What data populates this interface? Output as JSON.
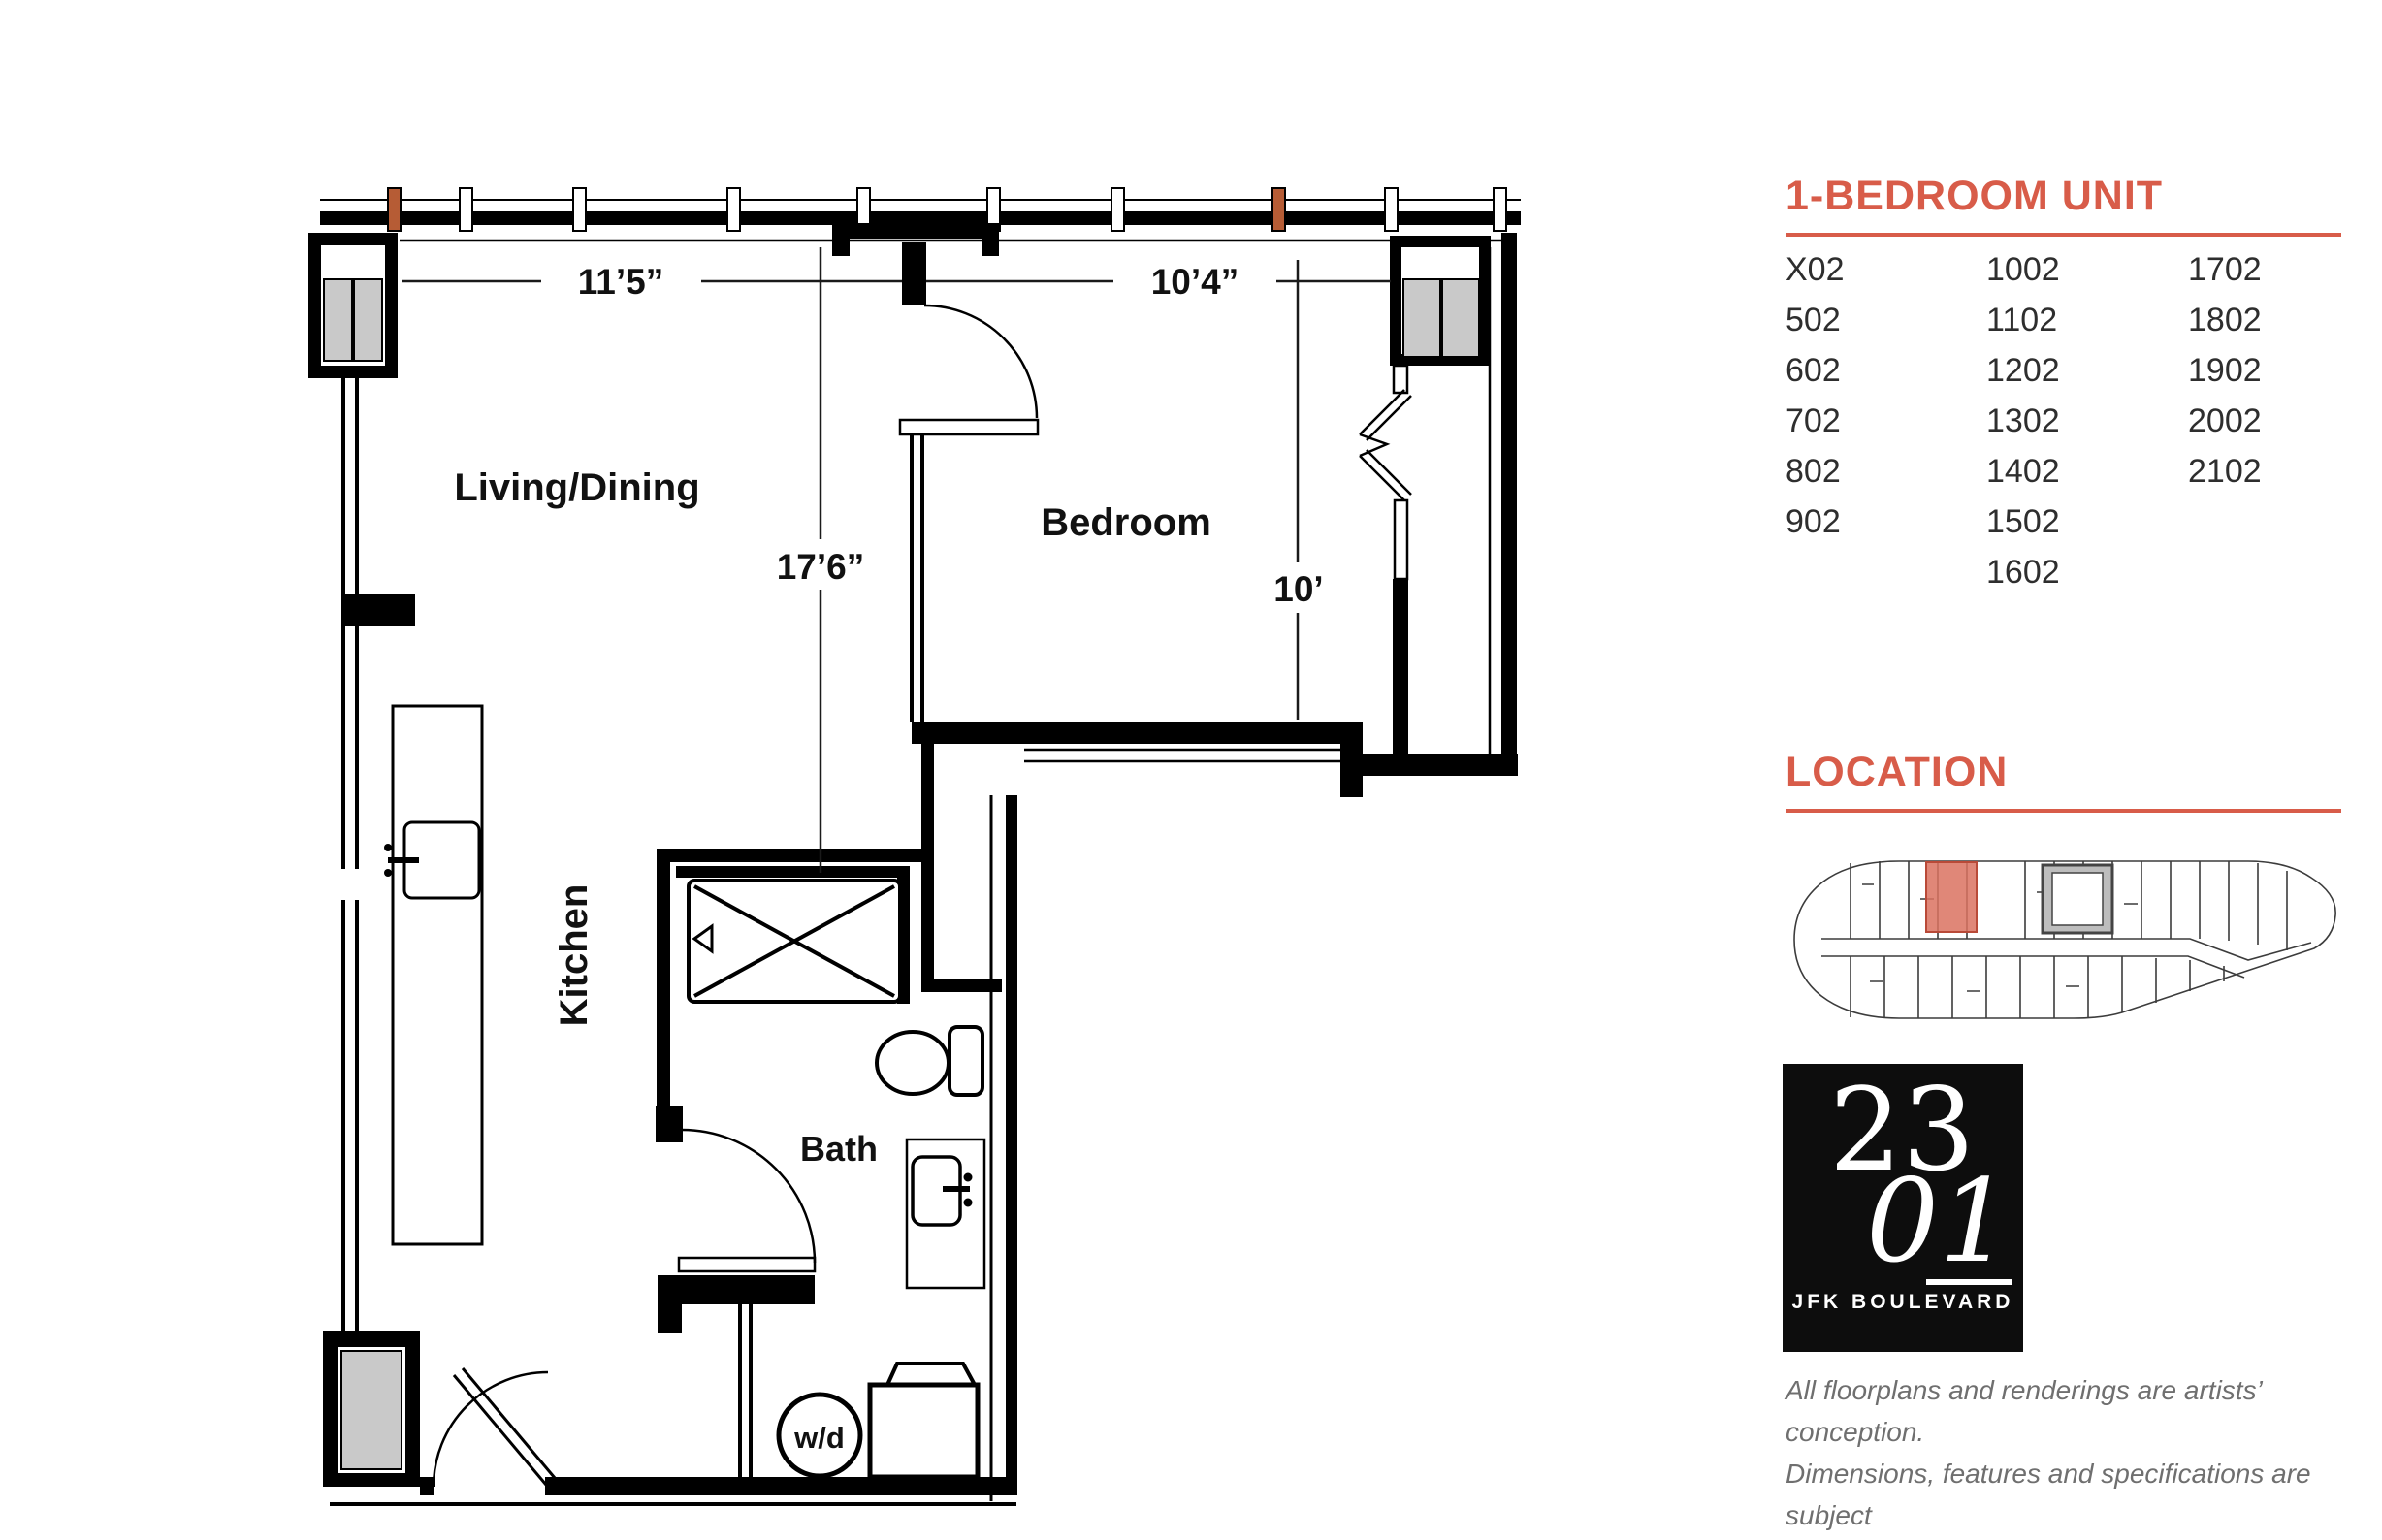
{
  "floor_plan": {
    "rooms": {
      "living": "Living/Dining",
      "bedroom": "Bedroom",
      "kitchen": "Kitchen",
      "bath": "Bath",
      "washer_dryer": "w/d"
    },
    "dimensions": {
      "living_width": "11’5”",
      "bedroom_width": "10’4”",
      "living_length": "17’6”",
      "bedroom_depth": "10’"
    }
  },
  "sidebar": {
    "accent_color": "#d85c49",
    "unit_heading": "1-BEDROOM UNIT",
    "units": {
      "col1": [
        "X02",
        "502",
        "602",
        "702",
        "802",
        "902"
      ],
      "col2": [
        "1002",
        "1102",
        "1202",
        "1302",
        "1402",
        "1502",
        "1602"
      ],
      "col3": [
        "1702",
        "1802",
        "1902",
        "2002",
        "2102"
      ]
    },
    "location_heading": "LOCATION",
    "location": {
      "highlight_color": "#db7260"
    },
    "logo": {
      "line1": "23",
      "line2": "01",
      "subtitle": "JFK BOULEVARD"
    },
    "disclaimer": [
      "All floorplans and renderings are artists’ conception.",
      "Dimensions, features and specifications are subject",
      "to change at the discretion of the builder."
    ]
  }
}
